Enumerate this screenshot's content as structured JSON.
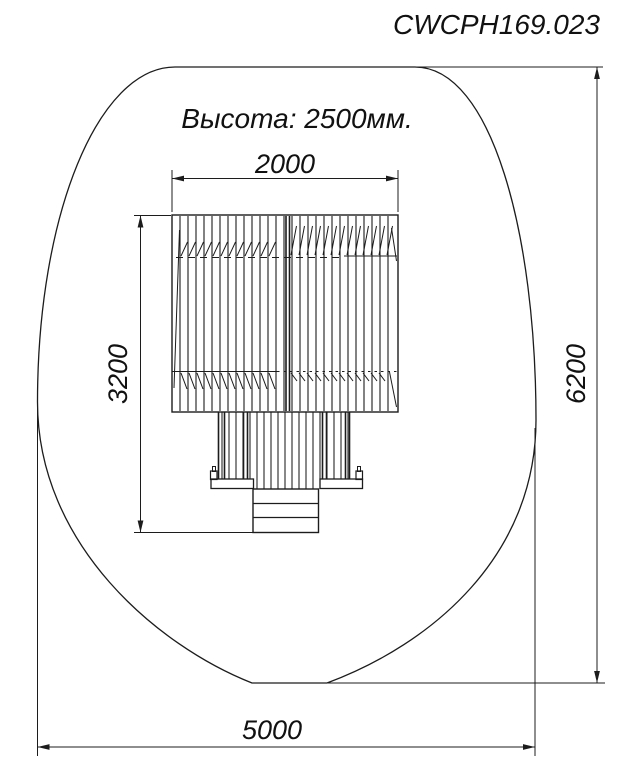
{
  "drawing": {
    "title": "CWCPH169.023",
    "height_note": "Высота: 2500мм.",
    "dimensions": {
      "top_width": "2000",
      "left_depth": "3200",
      "right_height": "6200",
      "bottom_width": "5000"
    },
    "line_color": "#1c1c1c",
    "background": "#ffffff"
  }
}
